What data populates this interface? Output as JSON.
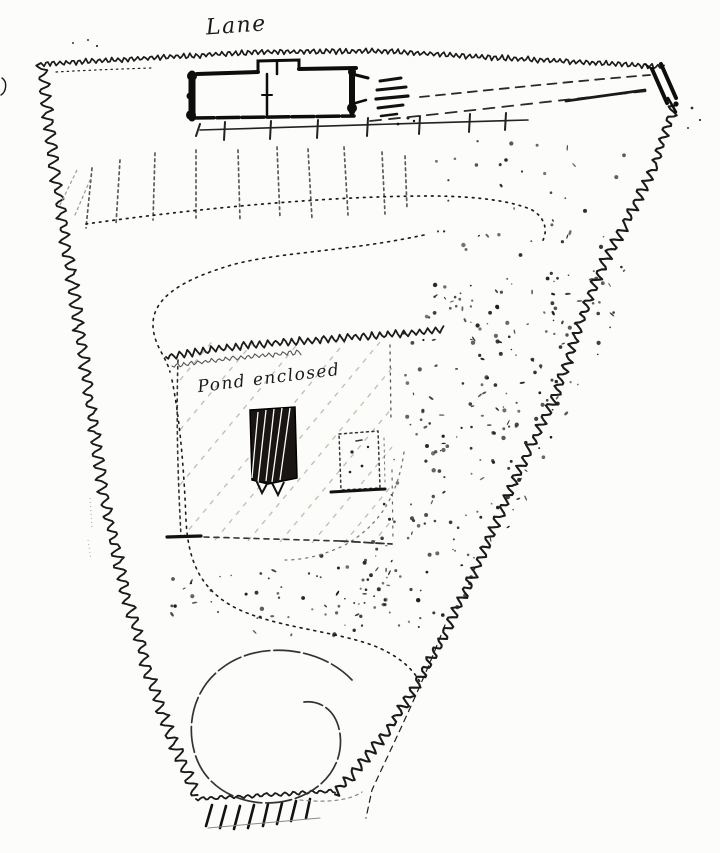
{
  "canvas": {
    "width": 720,
    "height": 853,
    "paper_color": "#fcfcfa",
    "ink_color": "#1b1b1b",
    "faint_pencil_color": "#b9b2a6"
  },
  "labels": {
    "lane": "Lane",
    "enclosure_note": "Pond enclosed"
  },
  "features": [
    "lane-label",
    "top-boundary-hedge",
    "left-boundary-hedge",
    "right-boundary-hedge",
    "bottom-boundary-wall",
    "bottom-wall-hatching",
    "corner-gate",
    "cottage-plan",
    "garden-fence",
    "steps-hatching",
    "lane-side-paths",
    "tree-row",
    "crossing-path",
    "winding-path",
    "enclosed-garden-bed",
    "bed-hatching",
    "bed-annotation",
    "dark-hatched-plot",
    "small-dotted-plot",
    "orchard-stipple",
    "spiral-walk"
  ]
}
